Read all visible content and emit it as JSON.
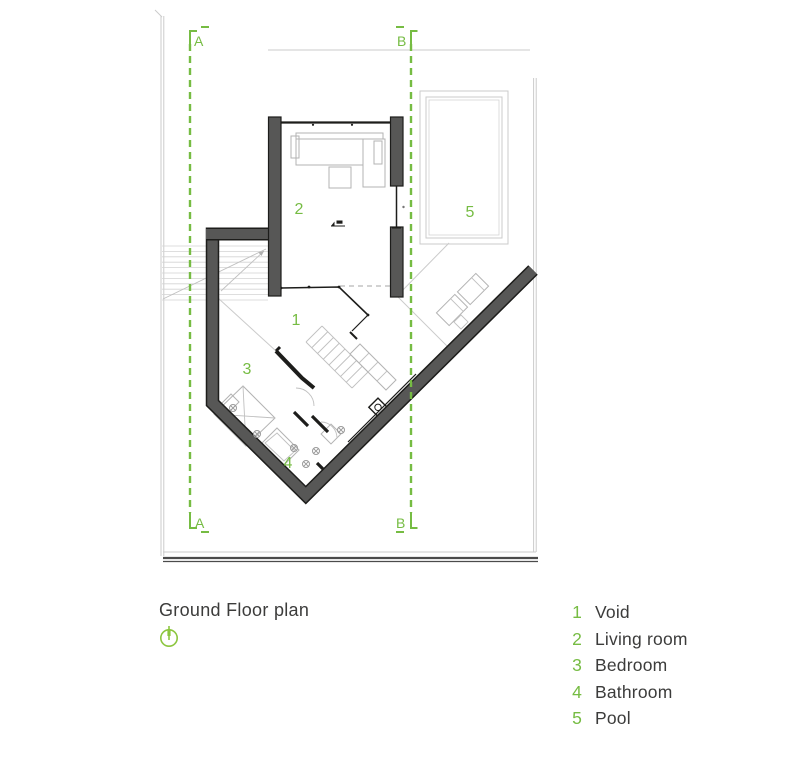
{
  "title": "Ground Floor plan",
  "north_icon": "north-arrow-icon",
  "sections": {
    "a": "A",
    "b": "B"
  },
  "plan": {
    "room_numbers": [
      "1",
      "2",
      "3",
      "4",
      "5"
    ]
  },
  "legend": {
    "items": [
      {
        "number": "1",
        "label": "Void"
      },
      {
        "number": "2",
        "label": "Living room"
      },
      {
        "number": "3",
        "label": "Bedroom"
      },
      {
        "number": "4",
        "label": "Bathroom"
      },
      {
        "number": "5",
        "label": "Pool"
      }
    ]
  },
  "colors": {
    "accent_green": "#76bc43",
    "wall_gray": "#575756",
    "wall_outline": "#1d1d1b",
    "line_light": "#cbcbcb",
    "text_dark": "#3c3c3b"
  }
}
